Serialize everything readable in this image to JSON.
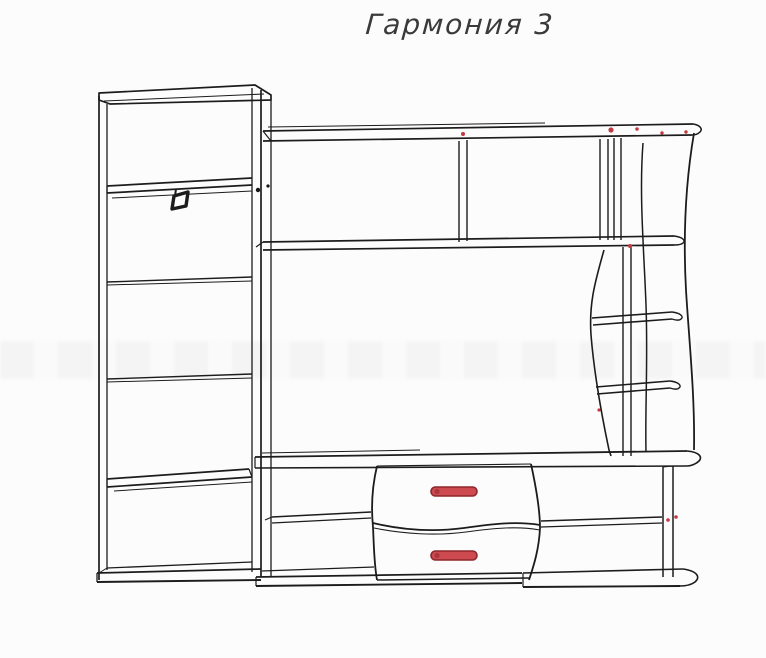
{
  "page": {
    "title": "Гармония 3",
    "background": "#fcfcfc"
  },
  "diagram": {
    "colors": {
      "line": "#1c1c1c",
      "accent": "#c23a41",
      "handle_fill": "#cd4a50",
      "handle_stroke": "#8e262b"
    },
    "drawer_handle_count": 2
  }
}
